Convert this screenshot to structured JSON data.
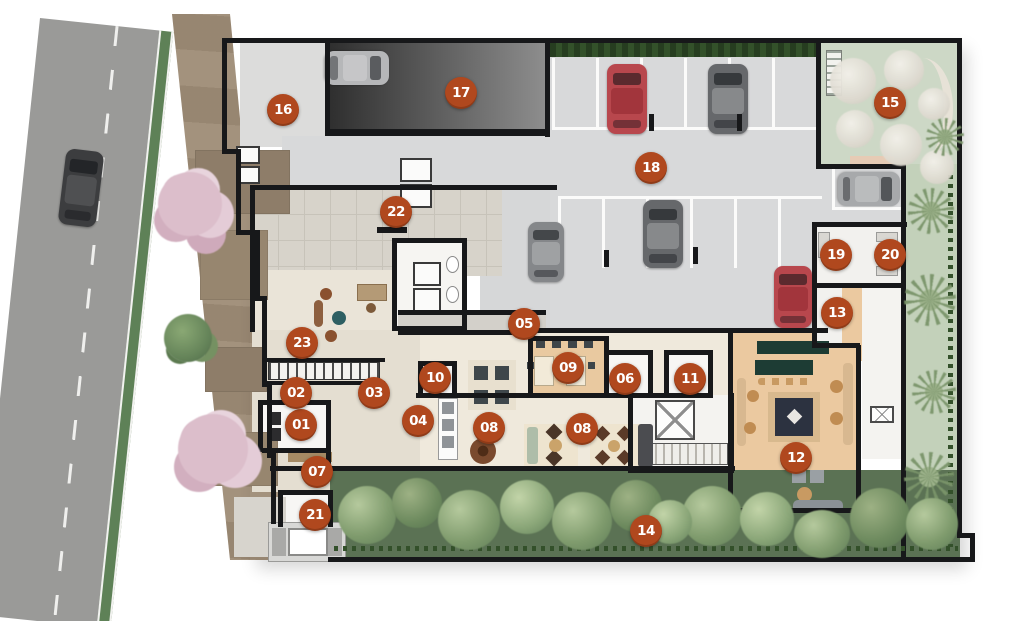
{
  "plan": {
    "type": "architectural-site-plan",
    "marker_style": {
      "bg": "#b0481e",
      "text": "#ffffff"
    },
    "markers": [
      {
        "label": "01",
        "x": 301,
        "y": 425
      },
      {
        "label": "02",
        "x": 296,
        "y": 393
      },
      {
        "label": "03",
        "x": 374,
        "y": 393
      },
      {
        "label": "04",
        "x": 418,
        "y": 421
      },
      {
        "label": "05",
        "x": 524,
        "y": 324
      },
      {
        "label": "06",
        "x": 625,
        "y": 379
      },
      {
        "label": "07",
        "x": 317,
        "y": 472
      },
      {
        "label": "08",
        "x": 489,
        "y": 428
      },
      {
        "label": "08",
        "x": 582,
        "y": 429
      },
      {
        "label": "09",
        "x": 568,
        "y": 368
      },
      {
        "label": "10",
        "x": 435,
        "y": 378
      },
      {
        "label": "11",
        "x": 690,
        "y": 379
      },
      {
        "label": "12",
        "x": 796,
        "y": 458
      },
      {
        "label": "13",
        "x": 837,
        "y": 313
      },
      {
        "label": "14",
        "x": 646,
        "y": 531
      },
      {
        "label": "15",
        "x": 890,
        "y": 103
      },
      {
        "label": "16",
        "x": 283,
        "y": 110
      },
      {
        "label": "17",
        "x": 461,
        "y": 93
      },
      {
        "label": "18",
        "x": 651,
        "y": 168
      },
      {
        "label": "19",
        "x": 836,
        "y": 255
      },
      {
        "label": "20",
        "x": 890,
        "y": 255
      },
      {
        "label": "21",
        "x": 315,
        "y": 515
      },
      {
        "label": "22",
        "x": 396,
        "y": 212
      },
      {
        "label": "23",
        "x": 302,
        "y": 343
      }
    ],
    "palette": {
      "road": "#9a9a98",
      "curb_green": "#5e8157",
      "sidewalk": "#a3927d",
      "floor_gray": "#dcdcdb",
      "parking_gray": "#d8d9da",
      "ramp_dark": "#3a3a3a",
      "floor_beige": "#eae4d8",
      "floor_tile": "#d7d3ca",
      "wood": "#ebc9a0",
      "garden_green": "#cdd8c6",
      "tree_strip": "#5b7254",
      "hedge": "#33512a",
      "car_red": "#b8474d",
      "car_gray": "#66686b",
      "wall": "#17181a"
    }
  }
}
